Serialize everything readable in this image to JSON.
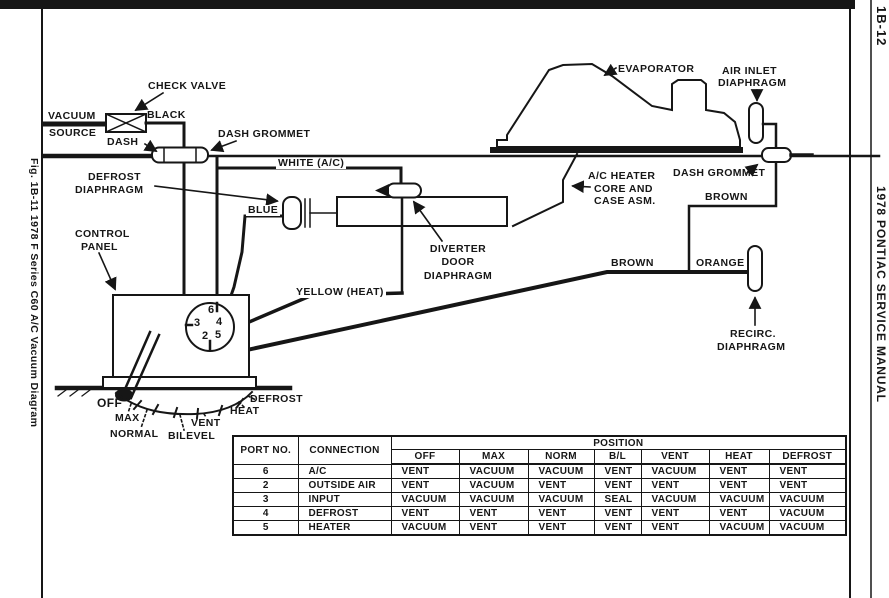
{
  "page": {
    "left_caption": "Fig. 1B-11 1978 F Series C60 A/C Vacuum Diagram",
    "page_number": "1B-12",
    "right_caption": "1978 PONTIAC SERVICE MANUAL"
  },
  "diagram": {
    "labels": {
      "check_valve": "CHECK VALVE",
      "vacuum_source_l1": "VACUUM",
      "vacuum_source_l2": "SOURCE",
      "black": "BLACK",
      "dash": "DASH",
      "dash_grommet_left": "DASH GROMMET",
      "white_ac": "WHITE (A/C)",
      "defrost_diaphragm_l1": "DEFROST",
      "defrost_diaphragm_l2": "DIAPHRAGM",
      "blue": "BLUE",
      "control_panel_l1": "CONTROL",
      "control_panel_l2": "PANEL",
      "diverter_l1": "DIVERTER",
      "diverter_l2": "DOOR",
      "diverter_l3": "DIAPHRAGM",
      "yellow_heat": "YELLOW (HEAT)",
      "evaporator": "EVAPORATOR",
      "air_inlet_l1": "AIR INLET",
      "air_inlet_l2": "DIAPHRAGM",
      "ac_heater_l1": "A/C HEATER",
      "ac_heater_l2": "CORE AND",
      "ac_heater_l3": "CASE ASM.",
      "dash_grommet_right": "DASH GROMMET",
      "brown_right": "BROWN",
      "brown_left": "BROWN",
      "orange": "ORANGE",
      "recirc_l1": "RECIRC.",
      "recirc_l2": "DIAPHRAGM",
      "pos_off": "OFF",
      "pos_max": "MAX",
      "pos_normal": "NORMAL",
      "pos_bilevel": "BILEVEL",
      "pos_vent": "VENT",
      "pos_heat": "HEAT",
      "pos_defrost": "DEFROST"
    },
    "ports": {
      "p6": "6",
      "p3": "3",
      "p4": "4",
      "p2": "2",
      "p5": "5"
    }
  },
  "table": {
    "position_header": "POSITION",
    "col_port": "PORT NO.",
    "col_connection": "CONNECTION",
    "position_columns": [
      "OFF",
      "MAX",
      "NORM",
      "B/L",
      "VENT",
      "HEAT",
      "DEFROST"
    ],
    "rows": [
      {
        "port": "6",
        "connection": "A/C",
        "values": [
          "VENT",
          "VACUUM",
          "VACUUM",
          "VENT",
          "VACUUM",
          "VENT",
          "VENT"
        ]
      },
      {
        "port": "2",
        "connection": "OUTSIDE AIR",
        "values": [
          "VENT",
          "VACUUM",
          "VENT",
          "VENT",
          "VENT",
          "VENT",
          "VENT"
        ]
      },
      {
        "port": "3",
        "connection": "INPUT",
        "values": [
          "VACUUM",
          "VACUUM",
          "VACUUM",
          "SEAL",
          "VACUUM",
          "VACUUM",
          "VACUUM"
        ]
      },
      {
        "port": "4",
        "connection": "DEFROST",
        "values": [
          "VENT",
          "VENT",
          "VENT",
          "VENT",
          "VENT",
          "VENT",
          "VACUUM"
        ]
      },
      {
        "port": "5",
        "connection": "HEATER",
        "values": [
          "VACUUM",
          "VENT",
          "VENT",
          "VENT",
          "VENT",
          "VACUUM",
          "VACUUM"
        ]
      }
    ]
  },
  "colors": {
    "ink": "#161616",
    "paper": "#ffffff"
  }
}
